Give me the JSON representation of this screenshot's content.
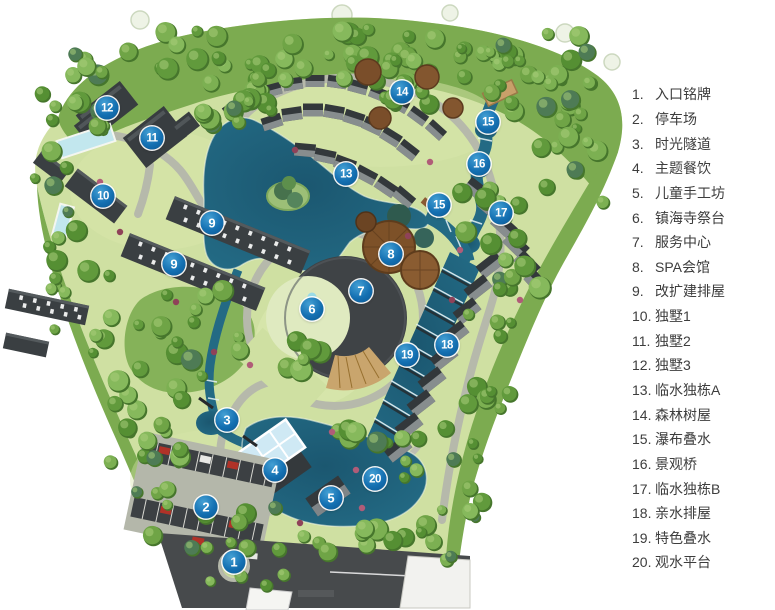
{
  "legend": {
    "items": [
      {
        "num": "1.",
        "label": "入口铭牌"
      },
      {
        "num": "2.",
        "label": "停车场"
      },
      {
        "num": "3.",
        "label": "时光隧道"
      },
      {
        "num": "4.",
        "label": "主题餐饮"
      },
      {
        "num": "5.",
        "label": "儿童手工坊"
      },
      {
        "num": "6.",
        "label": "镇海寺祭台"
      },
      {
        "num": "7.",
        "label": "服务中心"
      },
      {
        "num": "8.",
        "label": "SPA会馆"
      },
      {
        "num": "9.",
        "label": "改扩建排屋"
      },
      {
        "num": "10.",
        "label": "独墅1"
      },
      {
        "num": "11.",
        "label": "独墅2"
      },
      {
        "num": "12.",
        "label": "独墅3"
      },
      {
        "num": "13.",
        "label": "临水独栋A"
      },
      {
        "num": "14.",
        "label": "森林树屋"
      },
      {
        "num": "15.",
        "label": "瀑布叠水"
      },
      {
        "num": "16.",
        "label": "景观桥"
      },
      {
        "num": "17.",
        "label": "临水独栋B"
      },
      {
        "num": "18.",
        "label": "亲水排屋"
      },
      {
        "num": "19.",
        "label": "特色叠水"
      },
      {
        "num": "20.",
        "label": "观水平台"
      }
    ]
  },
  "markers": [
    {
      "n": "1",
      "x": 234,
      "y": 562
    },
    {
      "n": "2",
      "x": 206,
      "y": 507
    },
    {
      "n": "3",
      "x": 227,
      "y": 420
    },
    {
      "n": "4",
      "x": 275,
      "y": 470
    },
    {
      "n": "5",
      "x": 331,
      "y": 498
    },
    {
      "n": "6",
      "x": 312,
      "y": 309
    },
    {
      "n": "7",
      "x": 361,
      "y": 291
    },
    {
      "n": "8",
      "x": 391,
      "y": 254
    },
    {
      "n": "9",
      "x": 212,
      "y": 223
    },
    {
      "n": "9",
      "x": 174,
      "y": 264
    },
    {
      "n": "10",
      "x": 103,
      "y": 196
    },
    {
      "n": "11",
      "x": 152,
      "y": 138
    },
    {
      "n": "12",
      "x": 107,
      "y": 108
    },
    {
      "n": "13",
      "x": 346,
      "y": 174
    },
    {
      "n": "14",
      "x": 402,
      "y": 92
    },
    {
      "n": "15",
      "x": 488,
      "y": 122
    },
    {
      "n": "15",
      "x": 439,
      "y": 205
    },
    {
      "n": "16",
      "x": 479,
      "y": 164
    },
    {
      "n": "17",
      "x": 501,
      "y": 213
    },
    {
      "n": "18",
      "x": 447,
      "y": 345
    },
    {
      "n": "19",
      "x": 407,
      "y": 355
    },
    {
      "n": "20",
      "x": 375,
      "y": 479
    }
  ],
  "colors": {
    "marker": "#1470b2",
    "water": "#236a84",
    "water_deep": "#1b5770",
    "meadow": "#cfe0a2",
    "forest": "#7cab50",
    "road": "#b6b9ab",
    "road_dark": "#474a4c",
    "building": "#35393c",
    "roof_brown": "#7d5128",
    "deck_tan": "#c9a56d",
    "pool": "#c2e7ee"
  }
}
